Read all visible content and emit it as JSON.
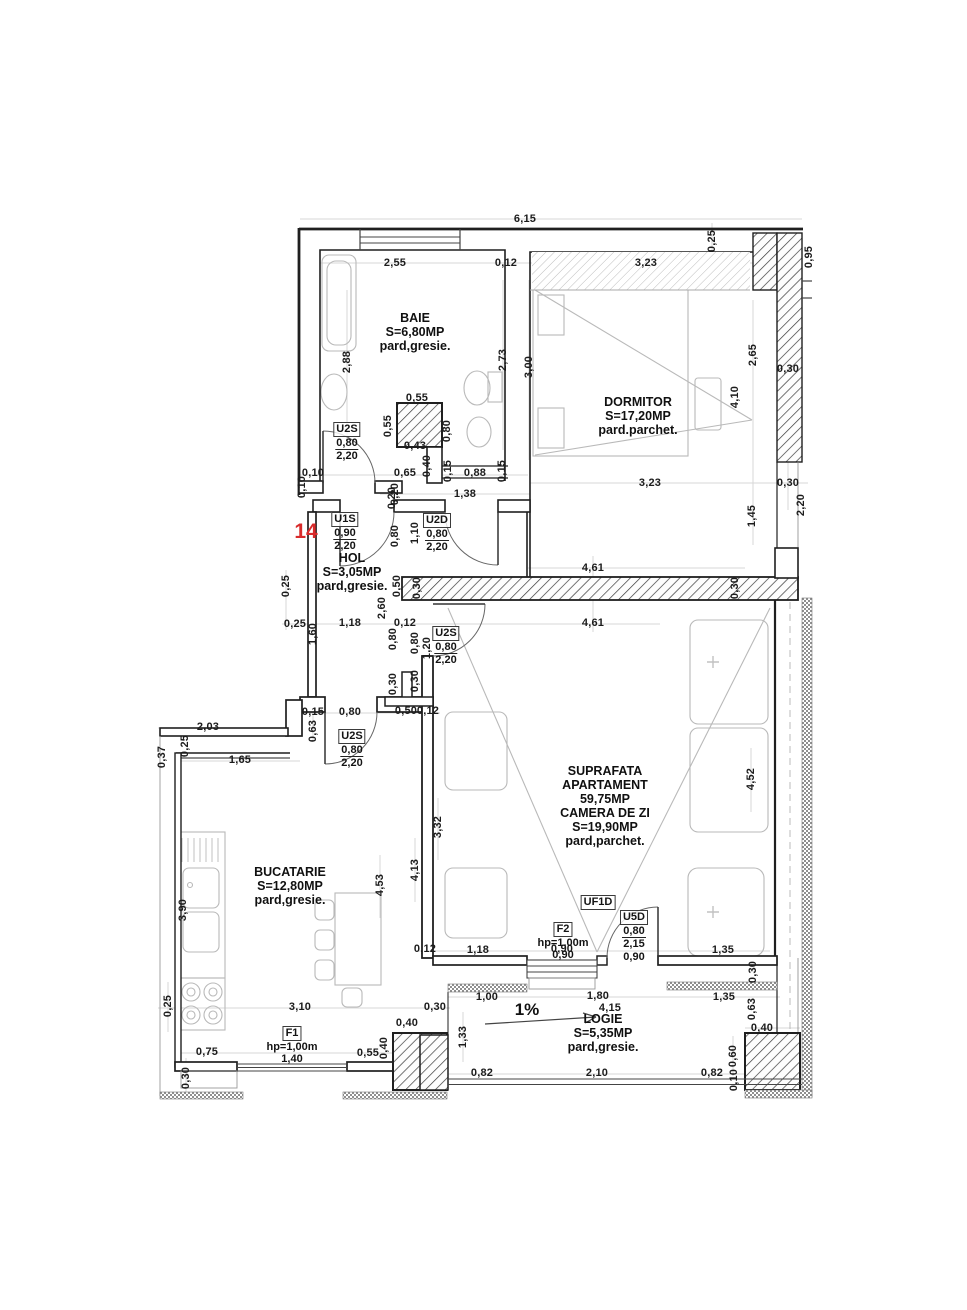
{
  "plan": {
    "unit_number": "14",
    "slope": "1%",
    "suprafata": [
      "SUPRAFATA",
      "APARTAMENT",
      "59,75MP"
    ]
  },
  "rooms": [
    {
      "name": "BAIE",
      "area": "S=6,80MP",
      "floor": "pard,gresie."
    },
    {
      "name": "DORMITOR",
      "area": "S=17,20MP",
      "floor": "pard.parchet."
    },
    {
      "name": "HOL",
      "area": "S=3,05MP",
      "floor": "pard,gresie."
    },
    {
      "name": "BUCATARIE",
      "area": "S=12,80MP",
      "floor": "pard,gresie."
    },
    {
      "name": "CAMERA DE ZI",
      "area": "S=19,90MP",
      "floor": "pard,parchet."
    },
    {
      "name": "LOGIE",
      "area": "S=5,35MP",
      "floor": "pard,gresie."
    }
  ],
  "openings": [
    {
      "code": "U2S",
      "lines": [
        "0,80",
        "2,20"
      ],
      "x": 347,
      "y": 422
    },
    {
      "code": "U1S",
      "lines": [
        "0,90",
        "2,20"
      ],
      "x": 345,
      "y": 512
    },
    {
      "code": "U2D",
      "lines": [
        "0,80",
        "2,20"
      ],
      "x": 437,
      "y": 513
    },
    {
      "code": "U2S",
      "lines": [
        "0,80",
        "2,20"
      ],
      "x": 446,
      "y": 626
    },
    {
      "code": "U2S",
      "lines": [
        "0,80",
        "2,20"
      ],
      "x": 352,
      "y": 729
    },
    {
      "code": "F1",
      "lines": [
        "hp=1,00m",
        "1,40"
      ],
      "x": 292,
      "y": 1026
    },
    {
      "code": "F2",
      "lines": [
        "hp=1,00m",
        "0,90"
      ],
      "x": 563,
      "y": 922
    },
    {
      "code": "UF1D",
      "lines": [],
      "x": 598,
      "y": 895
    },
    {
      "code": "U5D",
      "lines": [
        "0,80",
        "2,15",
        "0,90"
      ],
      "x": 634,
      "y": 910
    }
  ],
  "dimensions": [
    [
      "6,15",
      525,
      219,
      "h"
    ],
    [
      "2,55",
      395,
      263,
      "h"
    ],
    [
      "0,12",
      506,
      263,
      "h"
    ],
    [
      "3,23",
      646,
      263,
      "h"
    ],
    [
      "0,25",
      712,
      241,
      "v"
    ],
    [
      "0,95",
      809,
      257,
      "v"
    ],
    [
      "2,88",
      347,
      362,
      "v"
    ],
    [
      "2,73",
      503,
      360,
      "v"
    ],
    [
      "3,00",
      529,
      367,
      "v"
    ],
    [
      "0,55",
      417,
      398,
      "h"
    ],
    [
      "0,55",
      388,
      426,
      "v"
    ],
    [
      "0,80",
      447,
      431,
      "v"
    ],
    [
      "0,43",
      415,
      446,
      "h"
    ],
    [
      "0,40",
      427,
      466,
      "v"
    ],
    [
      "0,65",
      405,
      473,
      "h"
    ],
    [
      "0,15",
      448,
      471,
      "v"
    ],
    [
      "0,88",
      475,
      473,
      "h"
    ],
    [
      "0,15",
      502,
      471,
      "v"
    ],
    [
      "1,38",
      465,
      494,
      "h"
    ],
    [
      "0,10",
      313,
      473,
      "h"
    ],
    [
      "0,10",
      302,
      487,
      "v"
    ],
    [
      "0,20",
      395,
      494,
      "v"
    ],
    [
      "2,65",
      753,
      355,
      "v"
    ],
    [
      "4,10",
      735,
      397,
      "v"
    ],
    [
      "0,30",
      788,
      369,
      "h"
    ],
    [
      "3,23",
      650,
      483,
      "h"
    ],
    [
      "0,30",
      788,
      483,
      "h"
    ],
    [
      "1,45",
      752,
      516,
      "v"
    ],
    [
      "2,20",
      801,
      505,
      "v"
    ],
    [
      "0,80",
      395,
      536,
      "v"
    ],
    [
      "1,10",
      415,
      533,
      "v"
    ],
    [
      "0,20",
      392,
      498,
      "v"
    ],
    [
      "0,50",
      397,
      586,
      "v"
    ],
    [
      "0,30",
      417,
      588,
      "v"
    ],
    [
      "2,60",
      382,
      608,
      "v"
    ],
    [
      "4,61",
      593,
      568,
      "h"
    ],
    [
      "0,30",
      735,
      588,
      "v"
    ],
    [
      "4,61",
      593,
      623,
      "h"
    ],
    [
      "0,25",
      286,
      586,
      "v"
    ],
    [
      "0,25",
      295,
      624,
      "h"
    ],
    [
      "1,18",
      350,
      623,
      "h"
    ],
    [
      "0,12",
      405,
      623,
      "h"
    ],
    [
      "1,60",
      313,
      634,
      "v"
    ],
    [
      "0,80",
      393,
      639,
      "v"
    ],
    [
      "0,80",
      415,
      643,
      "v"
    ],
    [
      "1,20",
      427,
      648,
      "v"
    ],
    [
      "0,30",
      393,
      684,
      "v"
    ],
    [
      "0,30",
      415,
      681,
      "v"
    ],
    [
      "0,50",
      406,
      711,
      "h"
    ],
    [
      "0,12",
      428,
      711,
      "h"
    ],
    [
      "0,15",
      313,
      712,
      "h"
    ],
    [
      "0,80",
      350,
      712,
      "h"
    ],
    [
      "0,63",
      313,
      731,
      "v"
    ],
    [
      "2,03",
      208,
      727,
      "h"
    ],
    [
      "0,25",
      185,
      746,
      "v"
    ],
    [
      "0,37",
      162,
      757,
      "v"
    ],
    [
      "1,65",
      240,
      760,
      "h"
    ],
    [
      "3,90",
      183,
      910,
      "v"
    ],
    [
      "4,53",
      380,
      885,
      "v"
    ],
    [
      "3,32",
      438,
      827,
      "v"
    ],
    [
      "4,13",
      415,
      870,
      "v"
    ],
    [
      "3,10",
      300,
      1007,
      "h"
    ],
    [
      "0,25",
      168,
      1006,
      "v"
    ],
    [
      "0,75",
      207,
      1052,
      "h"
    ],
    [
      "0,55",
      368,
      1053,
      "h"
    ],
    [
      "0,40",
      384,
      1048,
      "v"
    ],
    [
      "0,40",
      407,
      1023,
      "h"
    ],
    [
      "0,30",
      435,
      1007,
      "h"
    ],
    [
      "0,30",
      186,
      1078,
      "v"
    ],
    [
      "4,52",
      751,
      779,
      "v"
    ],
    [
      "1,18",
      478,
      950,
      "h"
    ],
    [
      "0,12",
      425,
      949,
      "h"
    ],
    [
      "0,90",
      562,
      949,
      "h"
    ],
    [
      "1,35",
      723,
      950,
      "h"
    ],
    [
      "0,30",
      753,
      972,
      "v"
    ],
    [
      "1,00",
      487,
      997,
      "h"
    ],
    [
      "1,80",
      598,
      996,
      "h"
    ],
    [
      "4,15",
      610,
      1008,
      "h"
    ],
    [
      "1,33",
      463,
      1037,
      "v"
    ],
    [
      "0,82",
      482,
      1073,
      "h"
    ],
    [
      "2,10",
      597,
      1073,
      "h"
    ],
    [
      "0,82",
      712,
      1073,
      "h"
    ],
    [
      "1,35",
      724,
      997,
      "h"
    ],
    [
      "0,63",
      752,
      1009,
      "v"
    ],
    [
      "0,40",
      762,
      1028,
      "h"
    ],
    [
      "0,60",
      733,
      1056,
      "v"
    ],
    [
      "0,10",
      734,
      1080,
      "v"
    ]
  ]
}
